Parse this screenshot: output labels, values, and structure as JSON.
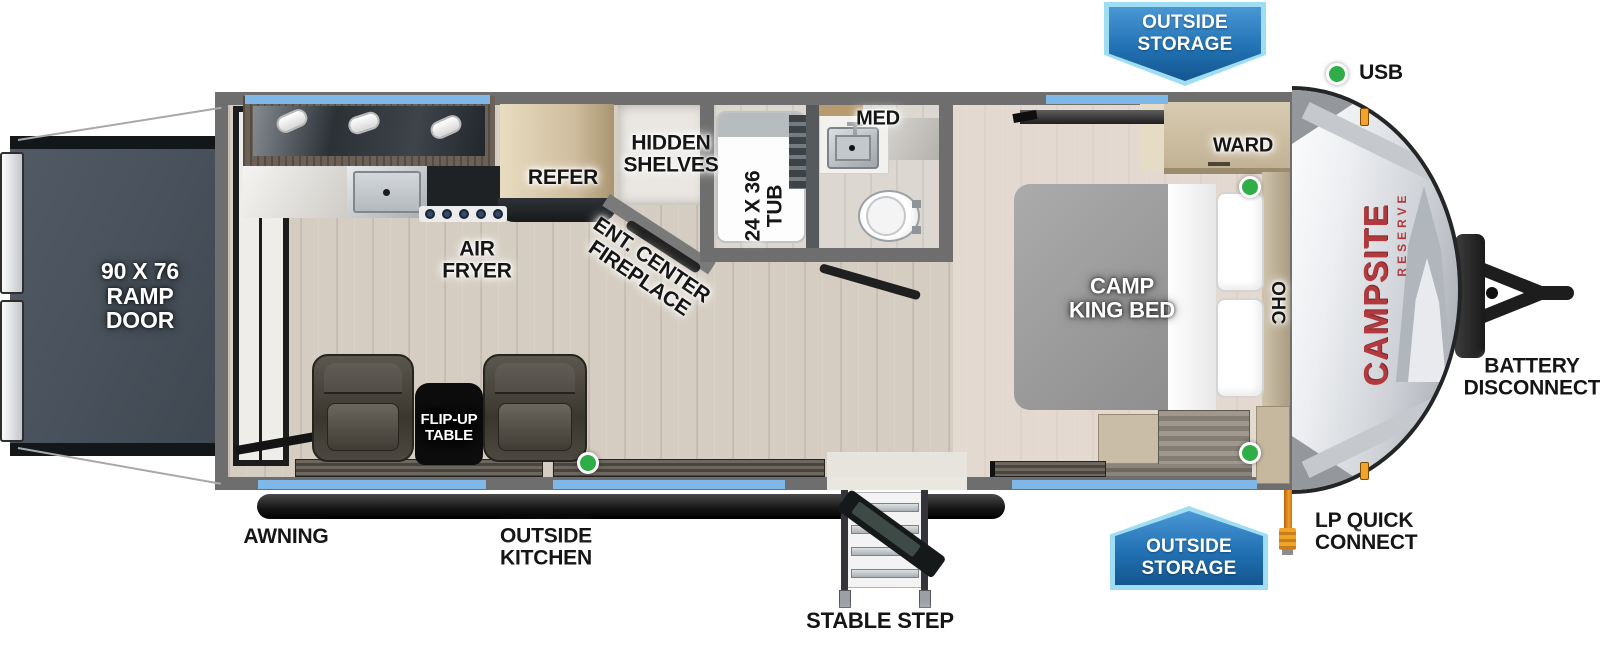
{
  "banners": {
    "top": "OUTSIDE\nSTORAGE",
    "bottom": "OUTSIDE\nSTORAGE"
  },
  "callouts": {
    "usb": "USB",
    "battery": "BATTERY\nDISCONNECT",
    "lp": "LP QUICK\nCONNECT",
    "stable_step": "STABLE STEP",
    "awning": "AWNING",
    "outside_kitchen": "OUTSIDE\nKITCHEN"
  },
  "interior": {
    "ramp_door": "90 X 76\nRAMP\nDOOR",
    "air_fryer": "AIR\nFRYER",
    "refer": "REFER",
    "hidden_shelves": "HIDDEN\nSHELVES",
    "fireplace": "ENT. CENTER\nFIREPLACE",
    "tub": "24 X 36\nTUB",
    "med": "MED",
    "bed": "CAMP\nKING BED",
    "ward": "WARD",
    "ohc": "OHC",
    "flip_table": "FLIP-UP\nTABLE"
  },
  "brand": {
    "name": "CAMPSITE",
    "series": "RESERVE"
  },
  "colors": {
    "banner_blue": "#2272b4",
    "banner_border": "#9fdef2",
    "window_blue": "#7fb7e7",
    "indicator_green": "#2fae47",
    "brand_red": "#b23a3e",
    "lp_orange": "#f29b2e",
    "wall_gray": "#6e6e6e",
    "ramp_slate": "#49525c"
  }
}
